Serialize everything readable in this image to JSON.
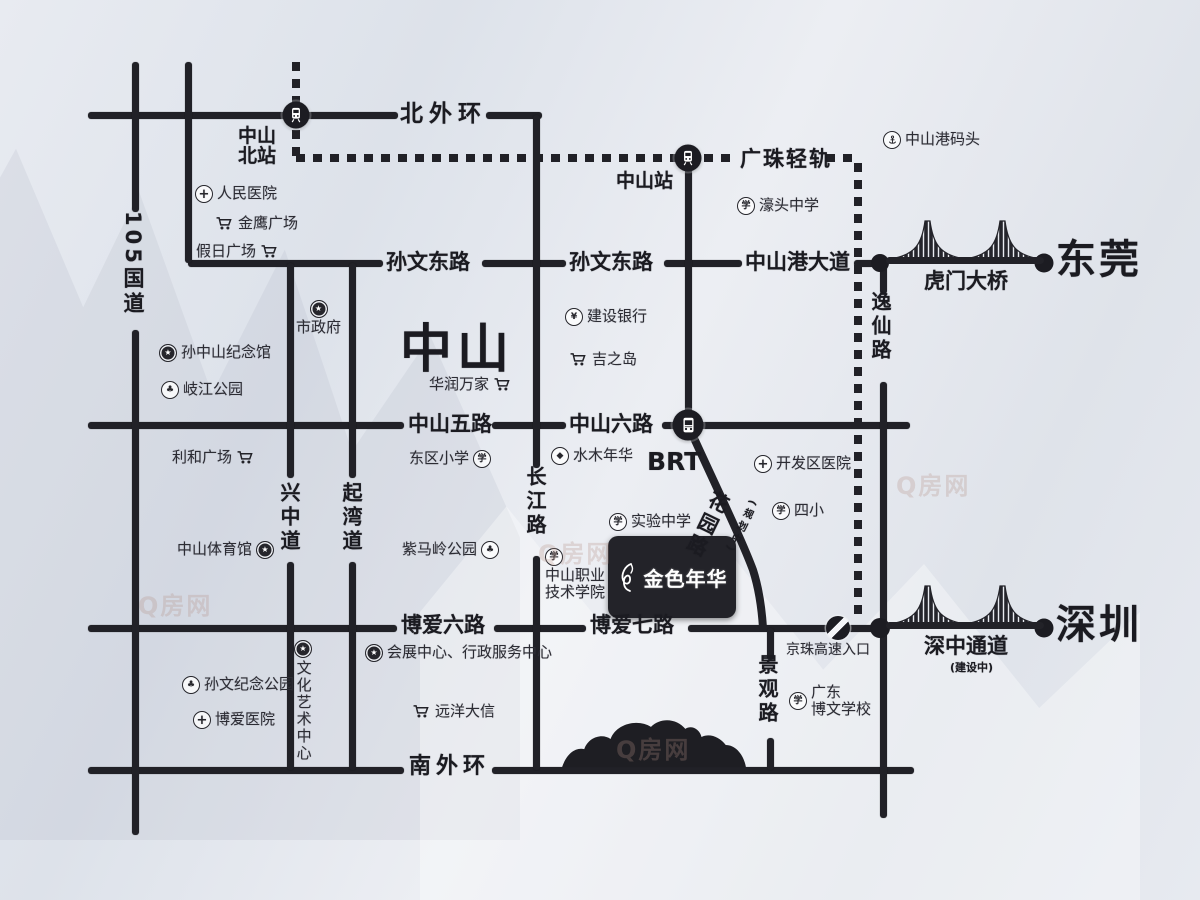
{
  "meta": {
    "title": "金色年华 区位示意图"
  },
  "colors": {
    "road": "#212127",
    "label_text": "#1b1b21",
    "landmark_text": "#2c2c34",
    "badge_bg": "#232329",
    "badge_text": "#ffffff",
    "bg_light": "#eceef3",
    "bg_dark": "#dde2ea",
    "watermark": "rgba(178,144,134,0.28)"
  },
  "project": {
    "name": "金色年华",
    "x": 608,
    "y": 536,
    "w": 128,
    "h": 82
  },
  "watermark_text": "Q房网",
  "watermarks": [
    {
      "x": 138,
      "y": 586
    },
    {
      "x": 538,
      "y": 534
    },
    {
      "x": 616,
      "y": 730
    },
    {
      "x": 896,
      "y": 466
    }
  ],
  "roads": {
    "horizontal": [
      {
        "name": "beiwaihuan-road",
        "y": 115,
        "segments": [
          [
            88,
            398
          ],
          [
            486,
            542
          ]
        ]
      },
      {
        "name": "sunwen-donglu-road",
        "y": 263,
        "segments": [
          [
            188,
            383
          ],
          [
            482,
            566
          ],
          [
            664,
            742
          ],
          [
            854,
            882
          ]
        ]
      },
      {
        "name": "zhongshan-wulu-liulu-road",
        "y": 425,
        "segments": [
          [
            88,
            404
          ],
          [
            492,
            566
          ],
          [
            662,
            910
          ]
        ]
      },
      {
        "name": "boai-road",
        "y": 628,
        "segments": [
          [
            88,
            397
          ],
          [
            494,
            586
          ],
          [
            688,
            880
          ]
        ]
      },
      {
        "name": "nanwaihuan-road",
        "y": 770,
        "segments": [
          [
            88,
            404
          ],
          [
            492,
            914
          ]
        ]
      }
    ],
    "vertical": [
      {
        "name": "guodao-105-road",
        "x": 135,
        "segments": [
          [
            62,
            212
          ],
          [
            330,
            835
          ]
        ]
      },
      {
        "name": "west-road",
        "x": 188,
        "segments": [
          [
            62,
            263
          ]
        ]
      },
      {
        "name": "xingzhong-dao-road",
        "x": 290,
        "segments": [
          [
            263,
            478
          ],
          [
            562,
            770
          ]
        ]
      },
      {
        "name": "qiwan-dao-road",
        "x": 352,
        "segments": [
          [
            263,
            478
          ],
          [
            562,
            770
          ]
        ]
      },
      {
        "name": "changjiang-lu-road",
        "x": 536,
        "segments": [
          [
            115,
            468
          ],
          [
            556,
            770
          ]
        ]
      },
      {
        "name": "station-spur-road",
        "x": 688,
        "segments": [
          [
            158,
            425
          ]
        ]
      },
      {
        "name": "jingguan-lu-road",
        "x": 770,
        "segments": [
          [
            628,
            660
          ],
          [
            738,
            770
          ]
        ]
      },
      {
        "name": "yixian-lu-road",
        "x": 883,
        "segments": [
          [
            263,
            294
          ],
          [
            382,
            628
          ],
          [
            632,
            818
          ]
        ]
      }
    ],
    "diagonal_huayuan_path": "M688,425 C712,478 742,540 753,570 C760,592 762,612 763,628"
  },
  "rail": {
    "horizontal": [
      {
        "y": 158,
        "segments": [
          [
            296,
            738
          ],
          [
            826,
            858
          ]
        ]
      }
    ],
    "vertical": [
      {
        "x": 296,
        "segments": [
          [
            62,
            158
          ]
        ]
      },
      {
        "x": 858,
        "segments": [
          [
            163,
            618
          ]
        ]
      }
    ]
  },
  "road_labels": [
    {
      "name": "label-beiwaihuan",
      "text": "北外环",
      "x": 400,
      "y": 102,
      "fs": 23,
      "ls": 6
    },
    {
      "name": "label-guangzhu-qinggui",
      "text": "广珠轻轨",
      "x": 740,
      "y": 148,
      "fs": 21,
      "ls": 2
    },
    {
      "name": "label-sunwen-donglu-west",
      "text": "孙文东路",
      "x": 386,
      "y": 251,
      "fs": 21
    },
    {
      "name": "label-sunwen-donglu-east",
      "text": "孙文东路",
      "x": 569,
      "y": 251,
      "fs": 21
    },
    {
      "name": "label-zhongshangang-dadao",
      "text": "中山港大道",
      "x": 745,
      "y": 251,
      "fs": 21
    },
    {
      "name": "label-zhongshan-wulu",
      "text": "中山五路",
      "x": 408,
      "y": 413,
      "fs": 21
    },
    {
      "name": "label-zhongshan-liulu",
      "text": "中山六路",
      "x": 569,
      "y": 413,
      "fs": 21
    },
    {
      "name": "label-brt",
      "text": "BRT",
      "x": 647,
      "y": 449,
      "fs": 25
    },
    {
      "name": "label-boai-liulu",
      "text": "博爱六路",
      "x": 401,
      "y": 614,
      "fs": 21
    },
    {
      "name": "label-boai-qilu",
      "text": "博爱七路",
      "x": 590,
      "y": 614,
      "fs": 21
    },
    {
      "name": "label-nanwaihuan",
      "text": "南外环",
      "x": 409,
      "y": 755,
      "fs": 22,
      "ls": 5
    },
    {
      "name": "label-zhongshan-city",
      "text": "中山",
      "x": 400,
      "y": 323,
      "fs": 52,
      "ls": 5
    },
    {
      "name": "label-guodao-105",
      "text": "105国道",
      "x": 122,
      "y": 211,
      "fs": 21,
      "vert": true
    },
    {
      "name": "label-xingzhong-dao",
      "text": "兴中道",
      "x": 278,
      "y": 482,
      "fs": 20,
      "vert": true
    },
    {
      "name": "label-qiwan-dao",
      "text": "起湾道",
      "x": 340,
      "y": 482,
      "fs": 20,
      "vert": true
    },
    {
      "name": "label-changjiang-lu",
      "text": "长江路",
      "x": 524,
      "y": 466,
      "fs": 20,
      "vert": true
    },
    {
      "name": "label-yixian-lu",
      "text": "逸仙路",
      "x": 869,
      "y": 291,
      "fs": 20,
      "vert": true
    },
    {
      "name": "label-jingguan-lu",
      "text": "景观路",
      "x": 756,
      "y": 654,
      "fs": 20,
      "vert": true
    },
    {
      "name": "label-huayuan-lu",
      "text": "花园路",
      "x": 711,
      "y": 492,
      "fs": 20,
      "vert": true,
      "rot": 26
    },
    {
      "name": "label-huayuan-sub",
      "text": "(规划中)",
      "x": 747,
      "y": 500,
      "fs": 10,
      "vert": true,
      "rot": 26
    },
    {
      "name": "label-zhongshanbei-station",
      "text": "中山\n北站",
      "x": 238,
      "y": 127,
      "fs": 19,
      "center": true
    },
    {
      "name": "label-zhongshan-station",
      "text": "中山站",
      "x": 616,
      "y": 172,
      "fs": 19
    }
  ],
  "landmarks": [
    {
      "name": "renmin-hospital",
      "text": "人民医院",
      "x": 195,
      "y": 185,
      "icon": "cross",
      "layout": "row"
    },
    {
      "name": "jinying-plaza",
      "text": "金鹰广场",
      "x": 215,
      "y": 215,
      "icon": "cart",
      "layout": "row"
    },
    {
      "name": "jiari-plaza",
      "text": "假日广场",
      "x": 196,
      "y": 243,
      "icon": "cart",
      "layout": "row-rev"
    },
    {
      "name": "shizhengfu",
      "text": "市政府",
      "x": 296,
      "y": 300,
      "icon": "star",
      "layout": "col"
    },
    {
      "name": "sunzhongshan-memorial",
      "text": "孙中山纪念馆",
      "x": 159,
      "y": 344,
      "icon": "star",
      "layout": "row"
    },
    {
      "name": "qijiang-park",
      "text": "岐江公园",
      "x": 161,
      "y": 381,
      "icon": "park",
      "layout": "row"
    },
    {
      "name": "lihe-plaza",
      "text": "利和广场",
      "x": 172,
      "y": 449,
      "icon": "cart",
      "layout": "row-rev"
    },
    {
      "name": "dongqu-primary-school",
      "text": "东区小学",
      "x": 409,
      "y": 450,
      "icon": "school",
      "layout": "row-rev"
    },
    {
      "name": "zhongshan-gym",
      "text": "中山体育馆",
      "x": 177,
      "y": 541,
      "icon": "star",
      "layout": "row-rev"
    },
    {
      "name": "zimaling-park",
      "text": "紫马岭公园",
      "x": 402,
      "y": 541,
      "icon": "park",
      "layout": "row-rev"
    },
    {
      "name": "huarun-wanjia",
      "text": "华润万家",
      "x": 429,
      "y": 376,
      "icon": "cart",
      "layout": "row-rev"
    },
    {
      "name": "jianshe-bank",
      "text": "建设银行",
      "x": 565,
      "y": 308,
      "icon": "bank",
      "layout": "row"
    },
    {
      "name": "jizhidao",
      "text": "吉之岛",
      "x": 569,
      "y": 351,
      "icon": "cart",
      "layout": "row"
    },
    {
      "name": "shuimu-nianhua",
      "text": "水木年华",
      "x": 551,
      "y": 447,
      "icon": "diamond",
      "layout": "row"
    },
    {
      "name": "shiyan-middle-school",
      "text": "实验中学",
      "x": 609,
      "y": 513,
      "icon": "school",
      "layout": "row"
    },
    {
      "name": "zhongshan-vocational-college",
      "text": "中山职业\n技术学院",
      "x": 545,
      "y": 548,
      "icon": "school",
      "layout": "col-left"
    },
    {
      "name": "kaifaqu-hospital",
      "text": "开发区医院",
      "x": 754,
      "y": 455,
      "icon": "cross",
      "layout": "row"
    },
    {
      "name": "sixiao-school",
      "text": "四小",
      "x": 772,
      "y": 502,
      "icon": "school",
      "layout": "row"
    },
    {
      "name": "haotou-middle-school",
      "text": "濠头中学",
      "x": 737,
      "y": 197,
      "icon": "school",
      "layout": "row"
    },
    {
      "name": "zhongshangang-wharf",
      "text": "中山港码头",
      "x": 883,
      "y": 131,
      "icon": "anchor",
      "layout": "row"
    },
    {
      "name": "sunwen-memorial-park",
      "text": "孙文纪念公园",
      "x": 182,
      "y": 676,
      "icon": "park",
      "layout": "row"
    },
    {
      "name": "boai-hospital",
      "text": "博爱医院",
      "x": 193,
      "y": 711,
      "icon": "cross",
      "layout": "row"
    },
    {
      "name": "huizhan-center",
      "text": "会展中心、行政服务中心",
      "x": 365,
      "y": 644,
      "icon": "star",
      "layout": "row"
    },
    {
      "name": "yuanyang-daxin",
      "text": "远洋大信",
      "x": 412,
      "y": 703,
      "icon": "cart",
      "layout": "row"
    },
    {
      "name": "bowen-school",
      "text": "广东\n博文学校",
      "x": 789,
      "y": 684,
      "icon": "school",
      "layout": "row"
    },
    {
      "name": "jingzhu-expressway-entrance-label",
      "text": "京珠高速入口",
      "x": 786,
      "y": 642,
      "icon": "none",
      "layout": "row",
      "fs": 14
    },
    {
      "name": "wenhua-art-center",
      "text": "文化艺术中心",
      "x": 294,
      "y": 640,
      "icon": "star",
      "layout": "col-vert"
    }
  ],
  "stations": [
    {
      "name": "zhongshanbei-station",
      "x": 296,
      "y": 115,
      "type": "train",
      "size": 27
    },
    {
      "name": "zhongshan-station",
      "x": 688,
      "y": 158,
      "type": "train",
      "size": 27
    },
    {
      "name": "brt-station",
      "x": 688,
      "y": 425,
      "type": "bus",
      "size": 31
    },
    {
      "name": "jingzhu-expressway-entrance",
      "x": 838,
      "y": 628,
      "type": "slash",
      "size": 24
    }
  ],
  "nodes": [
    {
      "x": 880,
      "y": 263,
      "r": 18
    },
    {
      "x": 1044,
      "y": 263,
      "r": 19
    },
    {
      "x": 880,
      "y": 628,
      "r": 20
    },
    {
      "x": 1044,
      "y": 628,
      "r": 19
    }
  ],
  "bridges": [
    {
      "name": "humen-bridge",
      "label": "虎门大桥",
      "sublabel": "",
      "city": "东莞",
      "x": 886,
      "y": 213
    },
    {
      "name": "shenzhong-corridor",
      "label": "深中通道",
      "sublabel": "(建设中)",
      "city": "深圳",
      "x": 886,
      "y": 578
    }
  ],
  "mountain": {
    "x": 558,
    "y": 708,
    "w": 192,
    "h": 64
  }
}
